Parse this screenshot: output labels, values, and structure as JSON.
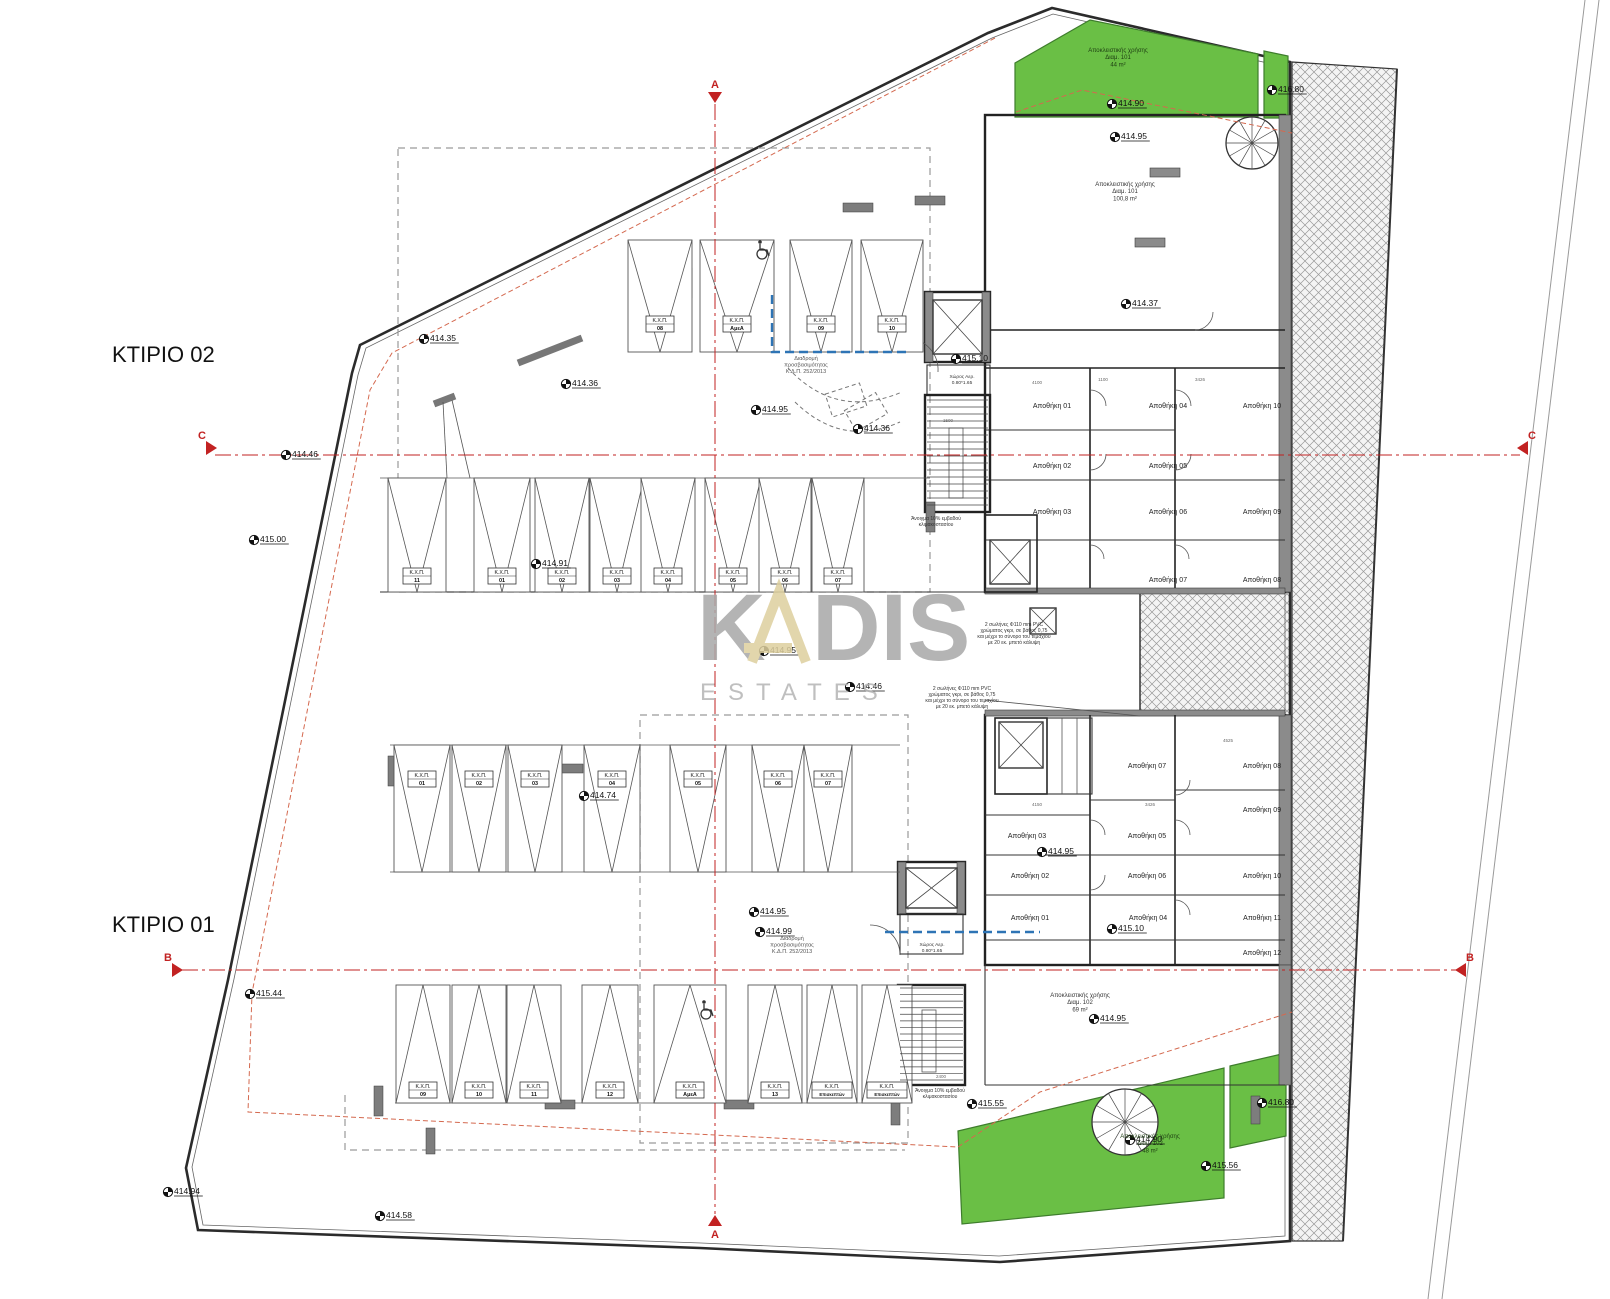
{
  "title_labels": [
    {
      "label": "ΚΤΙΡΙΟ 02",
      "x": 112,
      "y": 362
    },
    {
      "label": "ΚΤΙΡΙΟ 01",
      "x": 112,
      "y": 932
    }
  ],
  "watermark": {
    "word1": "KADIS",
    "word2": "ESTATES",
    "gray": "#a8a8a8",
    "beige": "#ddcf9e"
  },
  "colors": {
    "green_area": "#6abf45",
    "section_red": "#c22222",
    "setback_red": "#d4694f",
    "route_blue": "#2e74b5",
    "wall_dark": "#222222",
    "wall_gray": "#8b8b8b",
    "hatch_gray": "#9a9a9a"
  },
  "section_markers": [
    {
      "label": "A",
      "x": 715,
      "y": 92,
      "dir": "down"
    },
    {
      "label": "A",
      "x": 715,
      "y": 1226,
      "dir": "up"
    },
    {
      "label": "C",
      "x": 206,
      "y": 448,
      "dir": "right"
    },
    {
      "label": "C",
      "x": 1528,
      "y": 448,
      "dir": "left"
    },
    {
      "label": "B",
      "x": 172,
      "y": 970,
      "dir": "right"
    },
    {
      "label": "B",
      "x": 1466,
      "y": 970,
      "dir": "left"
    }
  ],
  "elevation_markers": [
    {
      "x": 424,
      "y": 339,
      "v": "414.35"
    },
    {
      "x": 286,
      "y": 455,
      "v": "414.46"
    },
    {
      "x": 566,
      "y": 384,
      "v": "414.36"
    },
    {
      "x": 756,
      "y": 410,
      "v": "414.95"
    },
    {
      "x": 858,
      "y": 429,
      "v": "414.36"
    },
    {
      "x": 254,
      "y": 540,
      "v": "415.00"
    },
    {
      "x": 536,
      "y": 564,
      "v": "414.91"
    },
    {
      "x": 764,
      "y": 651,
      "v": "414.95"
    },
    {
      "x": 850,
      "y": 687,
      "v": "414.46"
    },
    {
      "x": 584,
      "y": 796,
      "v": "414.74"
    },
    {
      "x": 754,
      "y": 912,
      "v": "414.95"
    },
    {
      "x": 760,
      "y": 932,
      "v": "414.99"
    },
    {
      "x": 250,
      "y": 994,
      "v": "415.44"
    },
    {
      "x": 956,
      "y": 359,
      "v": "415.10"
    },
    {
      "x": 1126,
      "y": 304,
      "v": "414.37"
    },
    {
      "x": 1112,
      "y": 104,
      "v": "414.90"
    },
    {
      "x": 1115,
      "y": 137,
      "v": "414.95"
    },
    {
      "x": 1272,
      "y": 90,
      "v": "416.80"
    },
    {
      "x": 1042,
      "y": 852,
      "v": "414.95"
    },
    {
      "x": 1112,
      "y": 929,
      "v": "415.10"
    },
    {
      "x": 1094,
      "y": 1019,
      "v": "414.95"
    },
    {
      "x": 972,
      "y": 1104,
      "v": "415.55"
    },
    {
      "x": 1130,
      "y": 1140,
      "v": "414.90"
    },
    {
      "x": 1206,
      "y": 1166,
      "v": "415.56"
    },
    {
      "x": 1262,
      "y": 1103,
      "v": "416.80"
    },
    {
      "x": 168,
      "y": 1192,
      "v": "414.94"
    },
    {
      "x": 380,
      "y": 1216,
      "v": "414.58"
    }
  ],
  "parking": {
    "prefix": "Κ.Χ.Π.",
    "rows": [
      {
        "name": "ktirio02-row-upper",
        "y1": 240,
        "y2": 352,
        "ly": 324,
        "dir": "down",
        "stalls": [
          {
            "cx": 660,
            "w": 64,
            "num": "08"
          },
          {
            "cx": 737,
            "w": 74,
            "num": "ΑμεΑ"
          },
          {
            "cx": 821,
            "w": 62,
            "num": "09"
          },
          {
            "cx": 892,
            "w": 62,
            "num": "10"
          }
        ]
      },
      {
        "name": "ktirio02-row-main",
        "y1": 478,
        "y2": 592,
        "ly": 576,
        "dir": "down",
        "stalls": [
          {
            "cx": 417,
            "w": 58,
            "num": "11"
          },
          {
            "cx": 502,
            "w": 56,
            "num": "01"
          },
          {
            "cx": 562,
            "w": 54,
            "num": "02"
          },
          {
            "cx": 617,
            "w": 54,
            "num": "03"
          },
          {
            "cx": 668,
            "w": 54,
            "num": "04"
          },
          {
            "cx": 733,
            "w": 56,
            "num": "05"
          },
          {
            "cx": 785,
            "w": 52,
            "num": "06"
          },
          {
            "cx": 838,
            "w": 52,
            "num": "07"
          }
        ]
      },
      {
        "name": "ktirio01-row-upper",
        "y1": 745,
        "y2": 872,
        "ly": 779,
        "dir": "down",
        "stalls": [
          {
            "cx": 422,
            "w": 56,
            "num": "01"
          },
          {
            "cx": 479,
            "w": 54,
            "num": "02"
          },
          {
            "cx": 535,
            "w": 54,
            "num": "03"
          },
          {
            "cx": 612,
            "w": 56,
            "num": "04"
          },
          {
            "cx": 698,
            "w": 56,
            "num": "05"
          },
          {
            "cx": 778,
            "w": 52,
            "num": "06"
          },
          {
            "cx": 828,
            "w": 48,
            "num": "07"
          }
        ]
      },
      {
        "name": "ktirio01-row-lower",
        "y1": 985,
        "y2": 1103,
        "ly": 1090,
        "dir": "up",
        "stalls": [
          {
            "cx": 423,
            "w": 54,
            "num": "09"
          },
          {
            "cx": 479,
            "w": 54,
            "num": "10"
          },
          {
            "cx": 534,
            "w": 54,
            "num": "11"
          },
          {
            "cx": 610,
            "w": 56,
            "num": "12"
          },
          {
            "cx": 690,
            "w": 72,
            "num": "ΑμεΑ"
          },
          {
            "cx": 775,
            "w": 54,
            "num": "13"
          },
          {
            "cx": 832,
            "w": 50,
            "num": "Επισκεπτών"
          },
          {
            "cx": 887,
            "w": 50,
            "num": "Επισκεπτών"
          }
        ]
      }
    ]
  },
  "storage": {
    "prefix": "Αποθήκη",
    "ktirio02": [
      {
        "x": 1052,
        "y": 408,
        "num": "01"
      },
      {
        "x": 1168,
        "y": 408,
        "num": "04"
      },
      {
        "x": 1262,
        "y": 408,
        "num": "10"
      },
      {
        "x": 1052,
        "y": 468,
        "num": "02"
      },
      {
        "x": 1168,
        "y": 468,
        "num": "05"
      },
      {
        "x": 1052,
        "y": 514,
        "num": "03"
      },
      {
        "x": 1168,
        "y": 514,
        "num": "06"
      },
      {
        "x": 1262,
        "y": 514,
        "num": "09"
      },
      {
        "x": 1168,
        "y": 582,
        "num": "07"
      },
      {
        "x": 1262,
        "y": 582,
        "num": "08"
      }
    ],
    "ktirio01": [
      {
        "x": 1147,
        "y": 768,
        "num": "07"
      },
      {
        "x": 1262,
        "y": 768,
        "num": "08"
      },
      {
        "x": 1027,
        "y": 838,
        "num": "03"
      },
      {
        "x": 1147,
        "y": 838,
        "num": "05"
      },
      {
        "x": 1262,
        "y": 812,
        "num": "09"
      },
      {
        "x": 1030,
        "y": 878,
        "num": "02"
      },
      {
        "x": 1147,
        "y": 878,
        "num": "06"
      },
      {
        "x": 1262,
        "y": 878,
        "num": "10"
      },
      {
        "x": 1030,
        "y": 920,
        "num": "01"
      },
      {
        "x": 1148,
        "y": 920,
        "num": "04"
      },
      {
        "x": 1262,
        "y": 920,
        "num": "11"
      },
      {
        "x": 1262,
        "y": 955,
        "num": "12"
      }
    ]
  },
  "notes": [
    {
      "name": "green-top-label",
      "x": 1118,
      "y": 52,
      "size": 6,
      "color": "#1d3d12",
      "lines": [
        "Αποκλειστικής χρήσης",
        "Διαμ. 101",
        "44 m²"
      ]
    },
    {
      "name": "room-top-label",
      "x": 1125,
      "y": 186,
      "size": 6,
      "color": "#333",
      "lines": [
        "Αποκλειστικής χρήσης",
        "Διαμ. 101",
        "100,8 m²"
      ]
    },
    {
      "name": "room-bottom-label",
      "x": 1080,
      "y": 997,
      "size": 6,
      "color": "#333",
      "lines": [
        "Αποκλειστικής χρήσης",
        "Διαμ. 102",
        "69 m²"
      ]
    },
    {
      "name": "green-bottom-label",
      "x": 1150,
      "y": 1138,
      "size": 6,
      "color": "#1d3d12",
      "lines": [
        "Αποκλειστικής χρήσης",
        "Διαμ. 102",
        "48 m²"
      ]
    },
    {
      "name": "accessibility-note-top",
      "x": 806,
      "y": 360,
      "size": 5.5,
      "color": "#555",
      "lines": [
        "Διαδρομή",
        "προσβασιμότητας",
        "Κ.Δ.Π. 252/2013"
      ]
    },
    {
      "name": "accessibility-note-bottom",
      "x": 792,
      "y": 940,
      "size": 5.5,
      "color": "#555",
      "lines": [
        "Διαδρομή",
        "προσβασιμότητας",
        "Κ.Δ.Π. 252/2013"
      ]
    },
    {
      "name": "pipes-note-1",
      "x": 1014,
      "y": 626,
      "size": 5,
      "color": "#333",
      "lines": [
        "2 σωλήνες Φ110 mm PVC",
        "χρώματος γκρι, σε βάθος 0,75",
        "και μέχρι το σύνορο του τεμαχίου",
        "με 20 εκ. μπετό κάλυψη"
      ]
    },
    {
      "name": "pipes-note-2",
      "x": 962,
      "y": 690,
      "size": 5,
      "color": "#333",
      "lines": [
        "2 σωλήνες Φ110 mm PVC",
        "χρώματος γκρι, σε βάθος 0,75",
        "και μέχρι το σύνορο του τεμαχίου",
        "με 20 εκ. μπετό κάλυψη"
      ]
    },
    {
      "name": "stair-vent-note-top",
      "x": 936,
      "y": 520,
      "size": 5,
      "color": "#333",
      "lines": [
        "Άνοιγμα 10% εμβαδού",
        "κλιμακοστασίου"
      ]
    },
    {
      "name": "stair-vent-note-bottom",
      "x": 940,
      "y": 1092,
      "size": 5,
      "color": "#333",
      "lines": [
        "Άνοιγμα 10% εμβαδού",
        "κλιμακοστασίου"
      ]
    },
    {
      "name": "vent-room-note-top",
      "x": 962,
      "y": 378,
      "size": 4.8,
      "color": "#333",
      "lines": [
        "Χώρος Αερ.",
        "0.80*1.65"
      ]
    },
    {
      "name": "vent-room-note-bottom",
      "x": 932,
      "y": 946,
      "size": 4.8,
      "color": "#333",
      "lines": [
        "Χώρος Αερ.",
        "0.80*1.65"
      ]
    }
  ],
  "dimension_labels": [
    {
      "x": 1037,
      "y": 384,
      "t": "4100"
    },
    {
      "x": 1103,
      "y": 381,
      "t": "1100"
    },
    {
      "x": 1200,
      "y": 381,
      "t": "3426"
    },
    {
      "x": 1037,
      "y": 806,
      "t": "4150"
    },
    {
      "x": 1150,
      "y": 806,
      "t": "3426"
    },
    {
      "x": 1228,
      "y": 742,
      "t": "4525"
    },
    {
      "x": 941,
      "y": 1078,
      "t": "2400"
    },
    {
      "x": 948,
      "y": 422,
      "t": "1500"
    }
  ],
  "wheelchair_icons": [
    {
      "x": 762,
      "y": 250
    },
    {
      "x": 706,
      "y": 1010
    }
  ]
}
